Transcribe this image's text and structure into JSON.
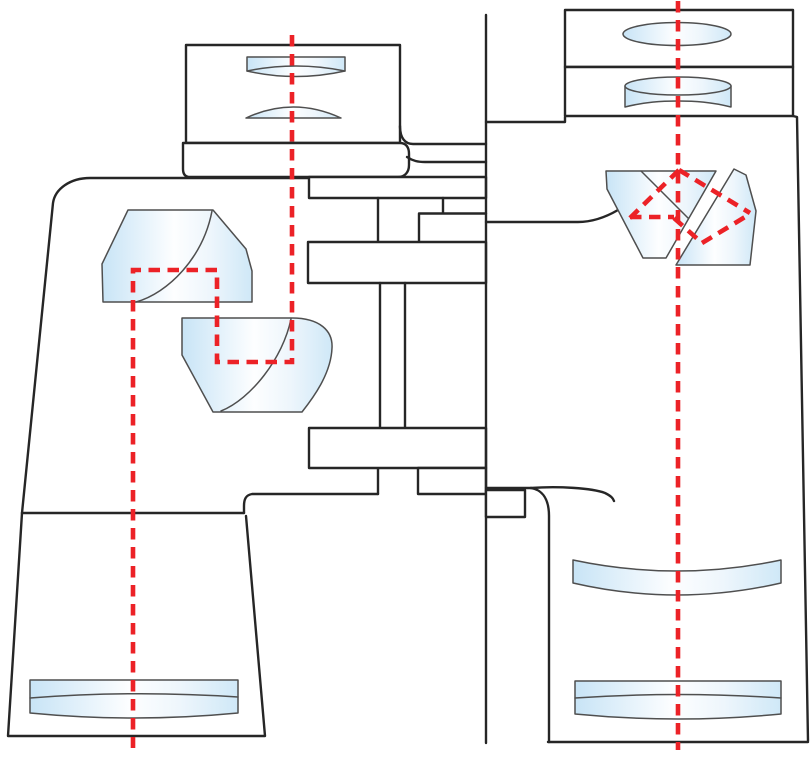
{
  "diagram": {
    "name": "porro-prism-binoculars-optical-diagram",
    "canvas": {
      "width": 812,
      "height": 757
    },
    "colors": {
      "background": "#ffffff",
      "outline": "#262626",
      "glass_stroke": "#4f4f4f",
      "ray_red": "#ec2227",
      "glass_edge_blue": "#c8e4f6",
      "glass_center_white": "#fdfeff",
      "glass_right_blue": "#cfe8f7"
    },
    "stroke_widths": {
      "body": 2.4,
      "glass": 1.5,
      "ray": 4.6
    },
    "ray_dash_pattern": "11.5 7.5",
    "shapes": [
      {
        "name": "left-barrel-outline-upper",
        "kind": "path",
        "cls": "body",
        "d": "M22,513 L53,203 C55,189 70,178 90,178 L310,178"
      },
      {
        "name": "left-barrel-outline-lower",
        "kind": "path",
        "cls": "body",
        "d": "M22,513 L8,736 L265,736 L246,516"
      },
      {
        "name": "left-barrel-seam-lower",
        "kind": "path",
        "cls": "body",
        "d": "M22,513 L244,513"
      },
      {
        "name": "left-barrel-seam-step",
        "kind": "path",
        "cls": "body",
        "d": "M378,494 L252,494 C246,495 244,499 244,506 L244,513"
      },
      {
        "name": "left-barrel-inner-wall",
        "kind": "path",
        "cls": "body",
        "d": "M378,468 L378,494"
      },
      {
        "name": "left-objective-lens",
        "kind": "path",
        "cls": "glass",
        "d": "M30,680 L238,680 L238,713 Q134,723 30,713 Z"
      },
      {
        "name": "left-objective-lens-seam",
        "kind": "path",
        "cls": "glassline",
        "d": "M30,698 Q134,690 238,697"
      },
      {
        "name": "left-porro-prism-upper",
        "kind": "path",
        "cls": "glass",
        "d": "M128,210 L213,210 L246,249 L252,271 L252,302 L103,302 L102,264 Z"
      },
      {
        "name": "left-porro-prism-upper-fold-line",
        "kind": "path",
        "cls": "glassline",
        "d": "M136,302 C168,293 203,258 212,211"
      },
      {
        "name": "left-porro-prism-lower",
        "kind": "path",
        "cls": "glass",
        "d": "M182,318 L292,318 C320,318 333,331 332,348 C331,374 313,398 302,412 L213,412 L182,355 Z"
      },
      {
        "name": "left-porro-prism-lower-fold-line",
        "kind": "path",
        "cls": "glassline",
        "d": "M221,411 C251,399 283,358 291,319"
      },
      {
        "name": "left-eyepiece-housing",
        "kind": "rect",
        "cls": "panel",
        "x": 186,
        "y": 45,
        "w": 214,
        "h": 98
      },
      {
        "name": "left-eye-lens",
        "kind": "path",
        "cls": "glass",
        "d": "M247,57 L345,57 L345,71 Q296,82 247,71 Z"
      },
      {
        "name": "left-eye-lens-rim",
        "kind": "path",
        "cls": "glassline",
        "d": "M247,71 Q296,61 345,71"
      },
      {
        "name": "left-field-lens",
        "kind": "path",
        "cls": "glass",
        "d": "M246,118 Q293,96 341,118 Z"
      },
      {
        "name": "left-eyepiece-flange",
        "kind": "path",
        "cls": "panel",
        "d": "M183,143 L400,143 C406,143 409,147 409,154 L409,165 C409,172 405,177 398,177 L190,177 C185,177 183,174 183,169 Z"
      },
      {
        "name": "hinge-bridge-upper-line",
        "kind": "path",
        "cls": "body",
        "d": "M400,126 C400,138 405,144 413,144 L486,144"
      },
      {
        "name": "hinge-bridge-lower-line",
        "kind": "path",
        "cls": "body",
        "d": "M407,157 C413,161 418,162 425,162 L486,162"
      },
      {
        "name": "hinge-plate-top",
        "kind": "rect",
        "cls": "panel",
        "x": 309,
        "y": 177,
        "w": 177,
        "h": 21
      },
      {
        "name": "hinge-step-lines",
        "kind": "path",
        "cls": "body",
        "d": "M443,198 L443,213 M486,213.5 L419,213.5 L419,242 M378,198 L378,242"
      },
      {
        "name": "hinge-plate-middle",
        "kind": "rect",
        "cls": "panel",
        "x": 308,
        "y": 242,
        "w": 178,
        "h": 41
      },
      {
        "name": "hinge-post",
        "kind": "path",
        "cls": "body",
        "d": "M380,283 L380,428 M405,283 L405,428"
      },
      {
        "name": "hinge-plate-bottom",
        "kind": "rect",
        "cls": "panel",
        "x": 309,
        "y": 428,
        "w": 177,
        "h": 40
      },
      {
        "name": "hinge-block-left",
        "kind": "rect",
        "cls": "panel",
        "x": 418,
        "y": 468,
        "w": 68,
        "h": 26
      },
      {
        "name": "hinge-axis-line",
        "kind": "path",
        "cls": "body",
        "d": "M486,15 L486,743"
      },
      {
        "name": "right-eyepiece-housing",
        "kind": "rect",
        "cls": "panel",
        "x": 565,
        "y": 10,
        "w": 228,
        "h": 57
      },
      {
        "name": "right-eye-lens",
        "kind": "ellipse",
        "cls": "glass",
        "cx": 677,
        "cy": 34,
        "rx": 54,
        "ry": 11.5
      },
      {
        "name": "right-field-lens-housing",
        "kind": "rect",
        "cls": "panel",
        "x": 565,
        "y": 67,
        "w": 228,
        "h": 49
      },
      {
        "name": "right-field-lens-body",
        "kind": "path",
        "cls": "glass",
        "d": "M625,86 L625,107 C645,102 661,101 678,101 C695,101 711,102 731,107 L731,86 Z"
      },
      {
        "name": "right-field-lens-top",
        "kind": "ellipse",
        "cls": "glass",
        "cx": 678,
        "cy": 86,
        "rx": 53,
        "ry": 9
      },
      {
        "name": "right-barrel-neck-step",
        "kind": "path",
        "cls": "body",
        "d": "M565,117 L565,122 L486,122"
      },
      {
        "name": "right-barrel-outer-edge",
        "kind": "path",
        "cls": "body",
        "d": "M793,116 L797,117 L808,741"
      },
      {
        "name": "right-barrel-bottom",
        "kind": "path",
        "cls": "body",
        "d": "M548,742 L808,742"
      },
      {
        "name": "right-barrel-shoulder-top",
        "kind": "path",
        "cls": "body",
        "d": "M486,488 L531,488"
      },
      {
        "name": "right-barrel-left-edge",
        "kind": "path",
        "cls": "body",
        "d": "M531,488 C543,490 549,500 549,516 L549,742"
      },
      {
        "name": "right-barrel-shoulder-contour",
        "kind": "path",
        "cls": "body",
        "d": "M531,488 C558,486 592,488 605,493 C611,496 613,498 614,501"
      },
      {
        "name": "right-barrel-prism-shelf",
        "kind": "path",
        "cls": "body",
        "d": "M486,222 L578,222 C592,222 606,217 618,210"
      },
      {
        "name": "hinge-block-right",
        "kind": "rect",
        "cls": "panel",
        "x": 486,
        "y": 490,
        "w": 39,
        "h": 27
      },
      {
        "name": "right-porro-prism-left",
        "kind": "path",
        "cls": "glass",
        "d": "M606,171 L716,171 L666,258 L643,258 L607,189 Z"
      },
      {
        "name": "right-porro-prism-left-fold-line",
        "kind": "path",
        "cls": "glassline",
        "d": "M641,171 L688,218"
      },
      {
        "name": "right-porro-prism-right",
        "kind": "path",
        "cls": "glass",
        "d": "M734,169 L746,175 L756,211 L750,265 L676,265 Z"
      },
      {
        "name": "right-meniscus-lens",
        "kind": "path",
        "cls": "glass",
        "d": "M573,560 L573,583 Q677,607 781,583 L781,560 Q677,582 573,560 Z"
      },
      {
        "name": "right-objective-lens",
        "kind": "path",
        "cls": "glass",
        "d": "M575,681 L781,681 L781,714 Q678,724 575,714 Z"
      },
      {
        "name": "right-objective-lens-seam",
        "kind": "path",
        "cls": "glassline",
        "d": "M575,698 Q678,691 781,698"
      },
      {
        "name": "left-light-ray-path",
        "kind": "path",
        "cls": "ray",
        "d": "M292,35 L292,362 L217,362 L217,270 L133,270 L133,748"
      },
      {
        "name": "right-optical-axis-ray",
        "kind": "path",
        "cls": "ray",
        "d": "M678,1 L678,750"
      },
      {
        "name": "right-prism-ray-horizontal",
        "kind": "path",
        "cls": "ray",
        "d": "M630,217 L674,217"
      },
      {
        "name": "right-prism-ray-up-left",
        "kind": "path",
        "cls": "ray",
        "d": "M630,218 L679,170"
      },
      {
        "name": "right-prism-ray-down-right",
        "kind": "path",
        "cls": "ray",
        "d": "M679,170 L750,213"
      },
      {
        "name": "right-prism-ray-lower-left",
        "kind": "path",
        "cls": "ray",
        "d": "M674,218 L702,243"
      },
      {
        "name": "right-prism-ray-lower-right",
        "kind": "path",
        "cls": "ray",
        "d": "M702,243 L750,214"
      }
    ]
  }
}
